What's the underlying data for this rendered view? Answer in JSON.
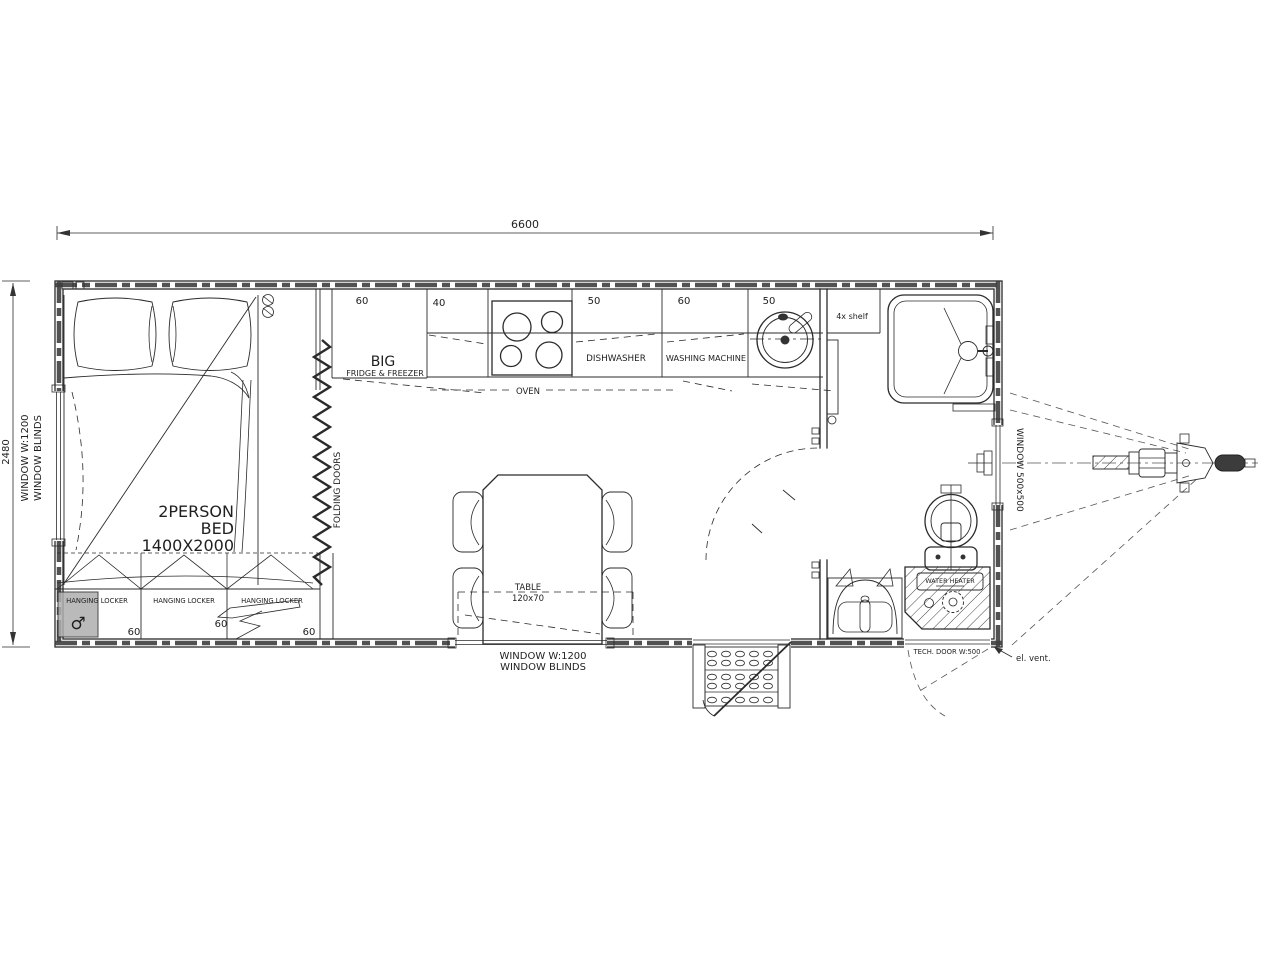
{
  "dimensions": {
    "length": "6600",
    "width": "2480"
  },
  "bedroom": {
    "window": {
      "line1": "WINDOW  W:1200",
      "line2": "WINDOW  BLINDS"
    },
    "bed": {
      "line1": "2PERSON",
      "line2": "BED",
      "line3": "1400X2000"
    },
    "lockers": [
      {
        "label": "HANGING LOCKER",
        "dim": "60"
      },
      {
        "label": "HANGING LOCKER",
        "dim": "60"
      },
      {
        "label": "HANGING LOCKER",
        "dim": "60"
      }
    ],
    "folding_doors": "FOLDING DOORS",
    "marker": "♂"
  },
  "kitchen": {
    "fridge": {
      "dim": "60",
      "line1": "BIG",
      "line2": "FRIDGE & FREEZER"
    },
    "cabinet": {
      "dim": "40"
    },
    "oven": "OVEN",
    "dishwasher": {
      "dim": "50",
      "label": "DISHWASHER"
    },
    "washing_machine": {
      "dim": "60",
      "label": "WASHING MACHINE"
    },
    "sink": {
      "dim": "50"
    },
    "shelf": "4x  shelf"
  },
  "dining": {
    "table": {
      "line1": "TABLE",
      "line2": "120x70"
    },
    "window": {
      "line1": "WINDOW  W:1200",
      "line2": "WINDOW  BLINDS"
    }
  },
  "bathroom": {
    "window": "WINDOW  500x500",
    "water_heater": "WATER HEATER",
    "tech_door": "TECH.  DOOR  W:500",
    "vent": "el.  vent."
  }
}
